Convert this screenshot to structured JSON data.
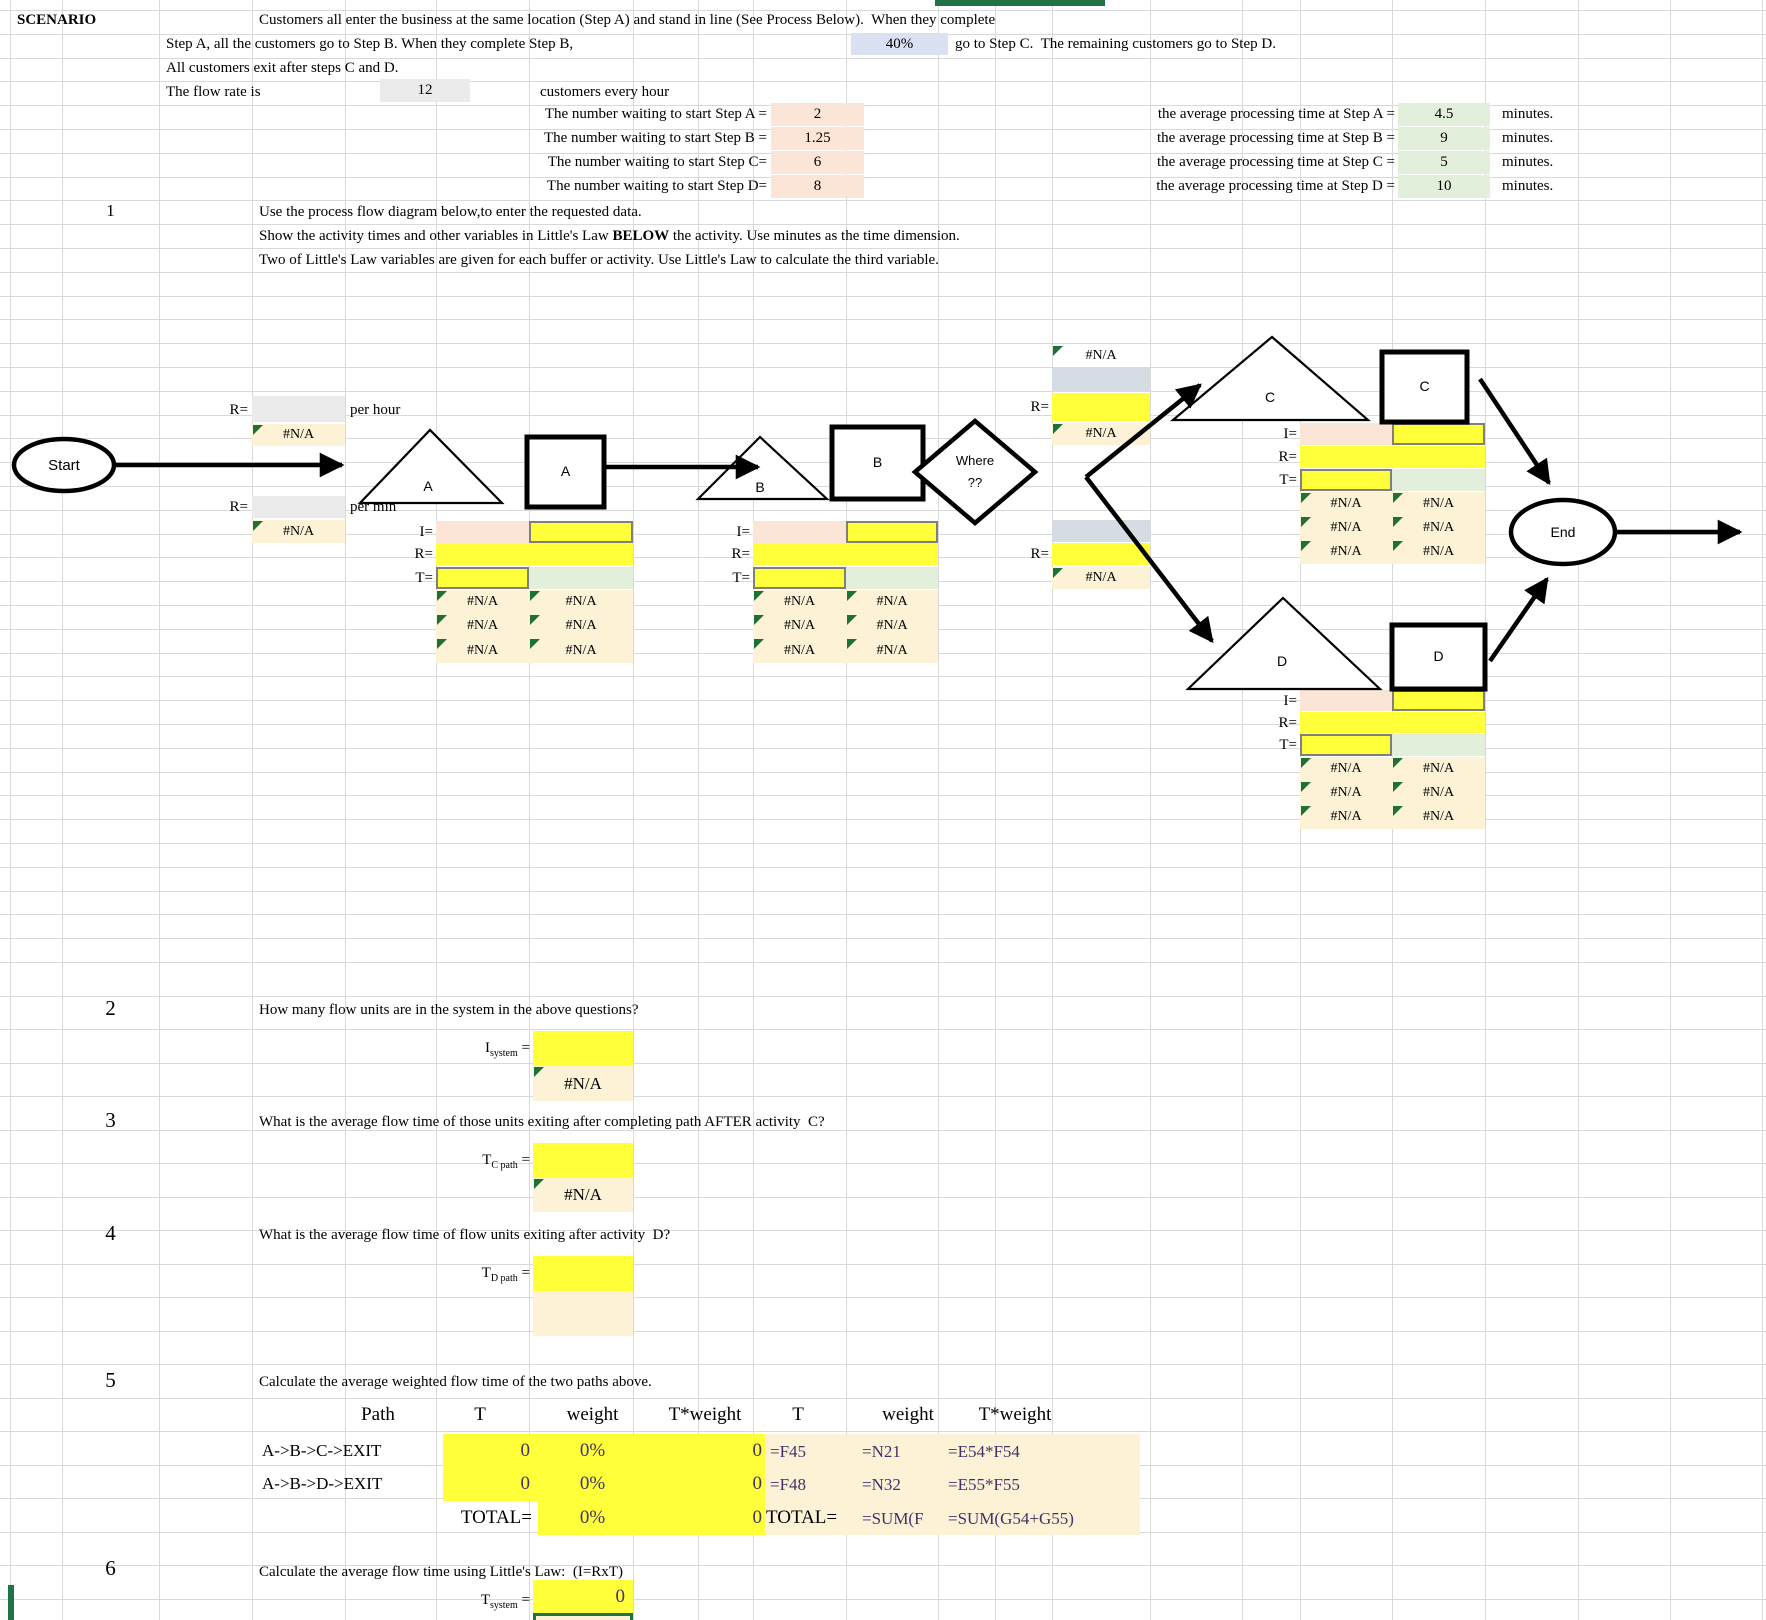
{
  "na": "#N/A",
  "labels": {
    "r": "R=",
    "i": "I=",
    "t": "T=",
    "eq": " =",
    "per_hour": "per hour",
    "per_min": "per min"
  },
  "colors": {
    "input_yellow": "#ffff3a",
    "result_cream": "#fdf2d6",
    "buffer_peach": "#fbe5d6",
    "activity_green": "#e2efda",
    "selection_green": "#217346",
    "formula_purple": "#433168"
  },
  "header": {
    "scenario_label": "SCENARIO",
    "line1": "Customers all enter the business at the same location (Step A) and stand in line (See Process Below).  When they complete",
    "line2a": "Step A, all the customers go to Step B. When they complete Step B,",
    "pct": "40%",
    "line2b": "go to Step C.  The remaining customers go to Step D.",
    "line3": "All customers exit after steps C and D.",
    "flow_label": "The flow rate is",
    "flow_rate": "12",
    "flow_units": "customers every hour",
    "waiting": [
      {
        "label": "The number waiting to start Step A =",
        "value": "2"
      },
      {
        "label": "The number waiting to start Step B =",
        "value": "1.25"
      },
      {
        "label": "The number waiting to start Step C=",
        "value": "6"
      },
      {
        "label": "The number waiting to start Step D=",
        "value": "8"
      }
    ],
    "processing": [
      {
        "label": "the average processing time at Step A =",
        "value": "4.5",
        "unit": "minutes."
      },
      {
        "label": "the average processing time at Step B =",
        "value": "9",
        "unit": "minutes."
      },
      {
        "label": "the average processing time at Step C =",
        "value": "5",
        "unit": "minutes."
      },
      {
        "label": "the average processing time at Step D =",
        "value": "10",
        "unit": "minutes."
      }
    ]
  },
  "q1": {
    "num": "1",
    "line1": "Use the process flow diagram below,to enter the requested data.",
    "line2_pre": "Show the activity times and other variables in Little's Law ",
    "line2_bold": "BELOW",
    "line2_post": " the activity. Use minutes as the time dimension.",
    "line3": "Two of Little's Law variables are given for each buffer or activity. Use Little's Law to calculate the third variable."
  },
  "diagram": {
    "start": "Start",
    "end": "End",
    "buffer_a": "A",
    "activity_a": "A",
    "buffer_b": "B",
    "activity_b": "B",
    "buffer_c": "C",
    "activity_c": "C",
    "buffer_d": "D",
    "activity_d": "D",
    "decision_line1": "Where",
    "decision_line2": "??"
  },
  "q2": {
    "num": "2",
    "text": "How many flow units are in the system in the above questions?",
    "sym": "I",
    "sub": "system"
  },
  "q3": {
    "num": "3",
    "text": "What is the average flow time of those units exiting after completing path AFTER activity  C?",
    "sym": "T",
    "sub": "C path"
  },
  "q4": {
    "num": "4",
    "text": "What is the average flow time of flow units exiting after activity  D?",
    "sym": "T",
    "sub": "D path"
  },
  "q5": {
    "num": "5",
    "text": "Calculate the average weighted flow time of the two paths above.",
    "table": {
      "headers": [
        "Path",
        "T",
        "weight",
        "T*weight",
        "T",
        "weight",
        "T*weight"
      ],
      "rows": [
        {
          "path": "A->B->C->EXIT",
          "t": "0",
          "w": "0%",
          "tw": "0",
          "t2": "=F45",
          "w2": "=N21",
          "tw2": "=E54*F54"
        },
        {
          "path": "A->B->D->EXIT",
          "t": "0",
          "w": "0%",
          "tw": "0",
          "t2": "=F48",
          "w2": "=N32",
          "tw2": "=E55*F55"
        }
      ],
      "total_label": "TOTAL=",
      "total": {
        "w": "0%",
        "tw": "0",
        "label2": "TOTAL=",
        "w2": "=SUM(F",
        "tw2": "=SUM(G54+G55)"
      }
    }
  },
  "q6": {
    "num": "6",
    "text": "Calculate the average flow time using Little's Law:  (I=RxT)",
    "sym": "T",
    "sub": "system",
    "value": "0"
  }
}
